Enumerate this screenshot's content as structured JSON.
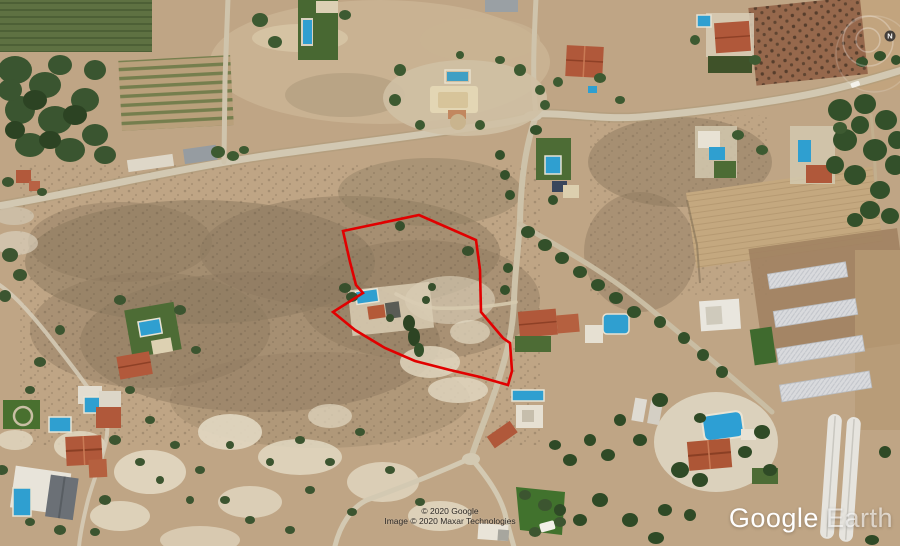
{
  "app": {
    "name": "Google Earth"
  },
  "watermark": {
    "primary": "Google",
    "secondary": "Earth"
  },
  "attribution": {
    "line1": "© 2020 Google",
    "line2": "Image © 2020 Maxar Technologies"
  },
  "compass": {
    "north_label": "N"
  },
  "parcel": {
    "stroke_color": "#e10000",
    "points": "343,231 419,215 476,240 480,270 481,312 503,338 510,343 512,371 508,385 480,377 450,370 415,361 385,348 355,330 333,312 363,293 356,285 350,262"
  },
  "colors": {
    "terrain_tan": "#bfa585",
    "scrub_brown": "#8d7a5f",
    "road": "#d2c8b2",
    "pool_blue": "#2f9fd0",
    "roof_terracotta": "#b0583a",
    "vegetation_dark": "#33502a",
    "greenhouse_white": "#dcdde0"
  }
}
